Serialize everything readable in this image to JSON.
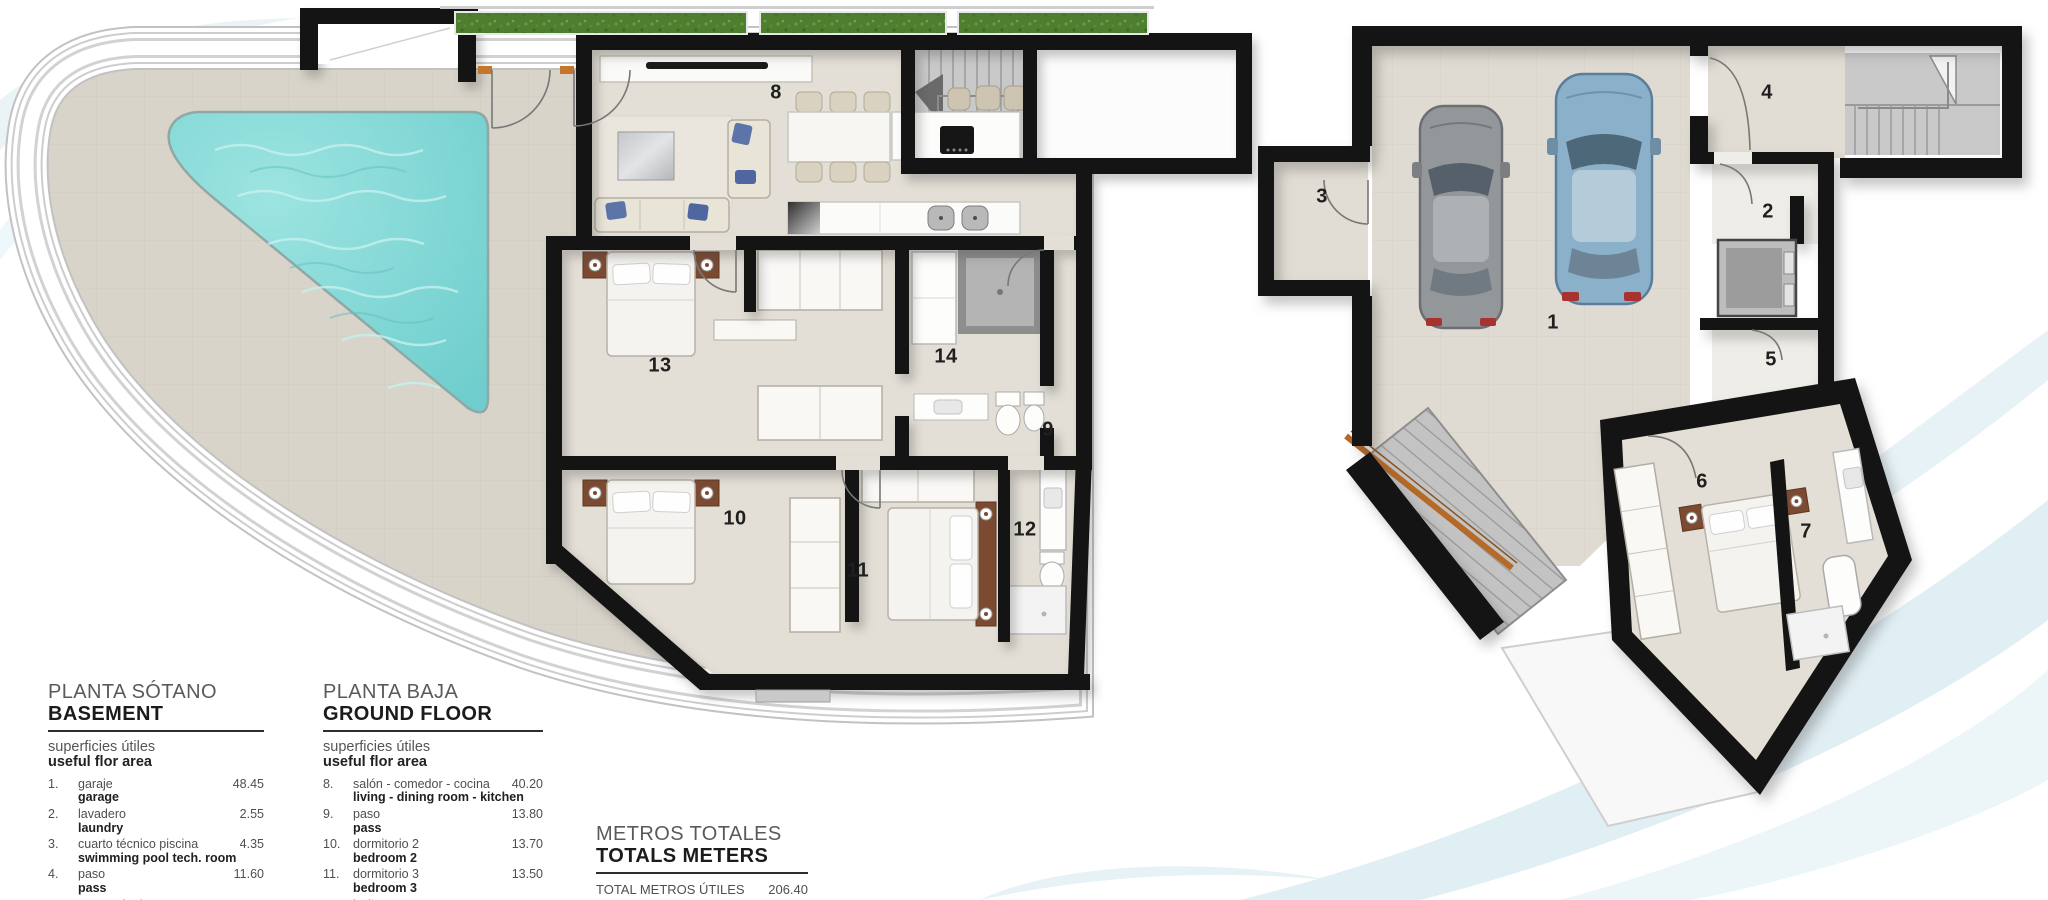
{
  "plans": {
    "ground_floor": {
      "room_labels": {
        "r8": "8",
        "r9": "9",
        "r10": "10",
        "r11": "11",
        "r12": "12",
        "r13": "13",
        "r14": "14"
      }
    },
    "basement": {
      "room_labels": {
        "r1": "1",
        "r2": "2",
        "r3": "3",
        "r4": "4",
        "r5": "5",
        "r6": "6",
        "r7": "7"
      }
    }
  },
  "legend": {
    "basement": {
      "title_es": "PLANTA SÓTANO",
      "title_en": "BASEMENT",
      "subtitle_es": "superficies útiles",
      "subtitle_en": "useful flor area",
      "items": [
        {
          "num": "1.",
          "es": "garaje",
          "en": "garage",
          "area": "48.45"
        },
        {
          "num": "2.",
          "es": "lavadero",
          "en": "laundry",
          "area": "2.55"
        },
        {
          "num": "3.",
          "es": "cuarto técnico piscina",
          "en": "swimming pool tech. room",
          "area": "4.35"
        },
        {
          "num": "4.",
          "es": "paso",
          "en": "pass",
          "area": "11.60"
        },
        {
          "num": "5.",
          "es": "cuarto técnico",
          "en": "",
          "area": "2.50"
        }
      ]
    },
    "ground_floor": {
      "title_es": "PLANTA BAJA",
      "title_en": "GROUND FLOOR",
      "subtitle_es": "superficies útiles",
      "subtitle_en": "useful flor area",
      "items": [
        {
          "num": "8.",
          "es": "salón - comedor - cocina",
          "en": "living - dining room - kitchen",
          "area": "40.20"
        },
        {
          "num": "9.",
          "es": "paso",
          "en": "pass",
          "area": "13.80"
        },
        {
          "num": "10.",
          "es": "dormitorio 2",
          "en": "bedroom 2",
          "area": "13.70"
        },
        {
          "num": "11.",
          "es": "dormitorio 3",
          "en": "bedroom 3",
          "area": "13.50"
        },
        {
          "num": "12.",
          "es": "baño 2",
          "en": "",
          "area": "4.80"
        }
      ]
    },
    "totals": {
      "title_es": "METROS TOTALES",
      "title_en": "TOTALS METERS",
      "row_es": "TOTAL METROS ÚTILES",
      "row_en": "TOTAL USEFUL METERS",
      "value": "206.40"
    }
  },
  "colors": {
    "wall": "#141414",
    "terrace": "#d8d4ca",
    "floor": "#e3dfd6",
    "pool": "#7fd5d4",
    "grass": "#4e7f2e",
    "stairs": "#c9c9c9",
    "wood": "#c4772c",
    "headboard": "#7b4a31",
    "car_gray": "#94979a",
    "car_blue": "#8bb0c9",
    "swirl": "#e0eff4"
  }
}
